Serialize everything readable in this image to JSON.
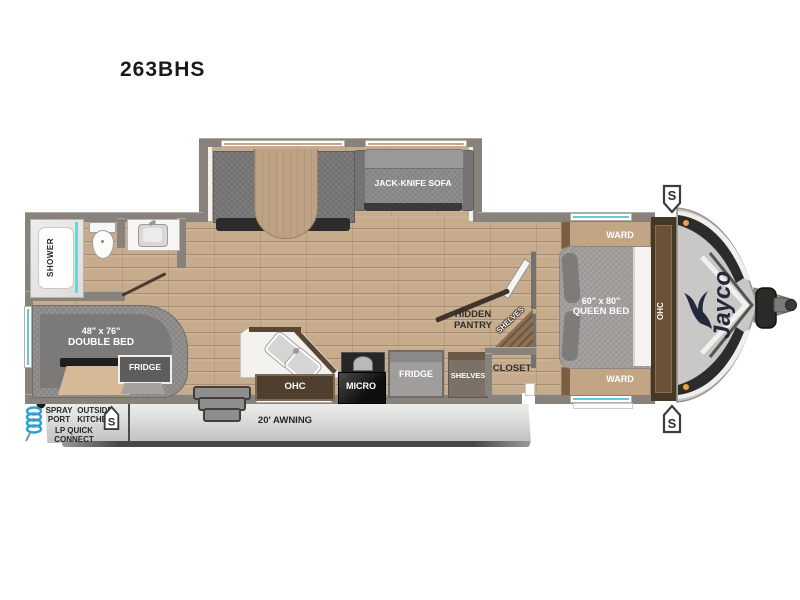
{
  "title": "263BHS",
  "colors": {
    "accent_teal": "#62ccd4",
    "wood_floor": "#c6ab8d",
    "wall_gray": "#87827c",
    "awning_gray": "#d9d9d8",
    "brand_navy": "#23283a",
    "marker_orange": "#f0a13a",
    "spray_hose_blue": "#2e9fd2"
  },
  "bathroom": {
    "shower": "SHOWER"
  },
  "dinette": {
    "sofa": "JACK-KNIFE SOFA"
  },
  "rear_bed": {
    "size": "48\" x 76\"",
    "name": "DOUBLE BED",
    "fridge": "FRIDGE"
  },
  "kitchen": {
    "ohc": "OHC",
    "micro": "MICRO",
    "fridge": "FRIDGE",
    "shelves": "SHELVES"
  },
  "pantry": {
    "hidden_1": "HIDDEN",
    "hidden_2": "PANTRY",
    "shelves": "SHELVES",
    "closet": "CLOSET"
  },
  "bedroom": {
    "ward_top": "WARD",
    "ward_bottom": "WARD",
    "size": "60\" x 80\"",
    "name": "QUEEN BED",
    "ohc": "OHC"
  },
  "exterior": {
    "spray_port_1": "SPRAY",
    "spray_port_2": "PORT",
    "outside_kitchen_1": "OUTSIDE",
    "outside_kitchen_2": "KITCHEN",
    "lp_1": "LP QUICK",
    "lp_2": "CONNECT",
    "awning": "20' AWNING",
    "stabilizer": "S",
    "brand": "Jayco"
  }
}
